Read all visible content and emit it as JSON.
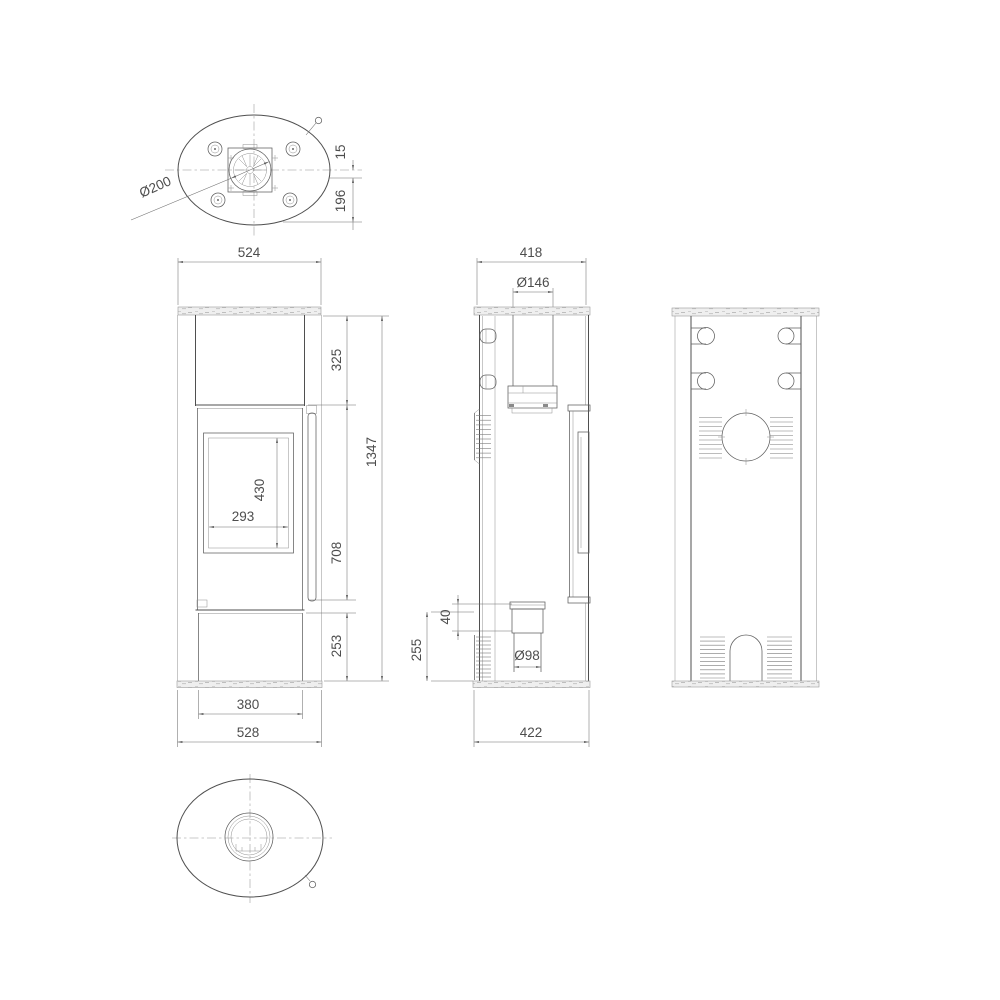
{
  "drawing": {
    "background_color": "#ffffff",
    "line_color": "#4f4f4f",
    "dimension_text_color": "#4d4d4d",
    "dimensions": {
      "top_view": {
        "flue_diameter": "Ø200",
        "rim_offset": "15",
        "center_to_rear": "196"
      },
      "front_view": {
        "top_plate_width": "524",
        "upper_section_height": "325",
        "total_height": "1347",
        "glass_height": "430",
        "glass_width": "293",
        "door_section_height": "708",
        "base_section_height": "253",
        "plinth_width": "380",
        "base_width": "528"
      },
      "side_view": {
        "top_depth": "418",
        "flue_outlet_diameter": "Ø146",
        "air_outlet_offset": "40",
        "lower_section_height": "255",
        "air_intake_diameter": "Ø98",
        "base_depth": "422"
      }
    }
  }
}
